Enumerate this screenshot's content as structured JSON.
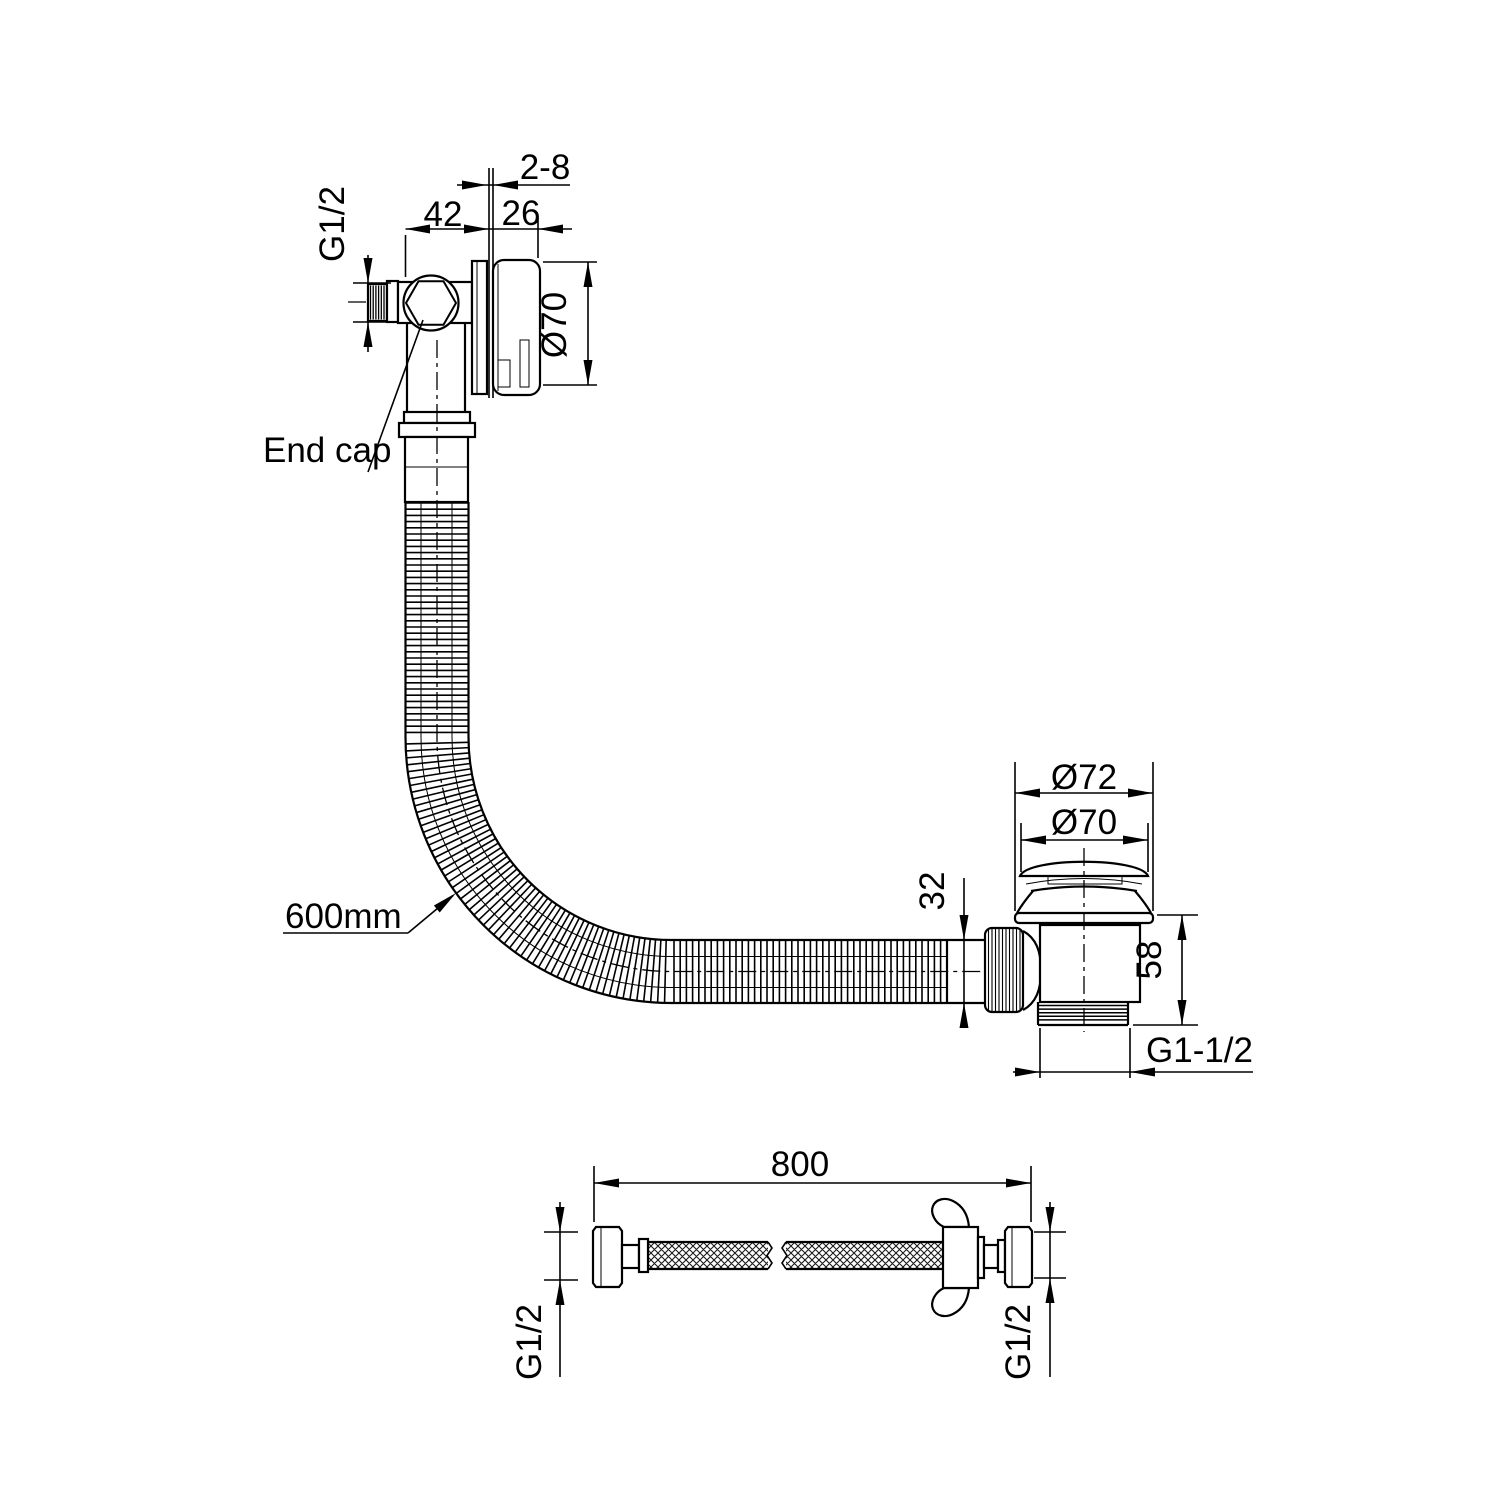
{
  "drawing": {
    "overflow": {
      "wall_thickness": "2-8",
      "depth_to_wall": "42",
      "cap_depth": "26",
      "inlet_thread": "G1/2",
      "cap_diameter": "Ø70",
      "end_cap_label": "End cap"
    },
    "overflow_hose": {
      "length_label": "600mm"
    },
    "waste": {
      "flange_diameter": "Ø72",
      "plug_diameter": "Ø70",
      "inlet_pipe_diameter": "32",
      "body_height": "58",
      "outlet_thread": "G1-1/2"
    },
    "supply_hose": {
      "length": "800",
      "left_thread": "G1/2",
      "right_thread": "G1/2"
    }
  }
}
